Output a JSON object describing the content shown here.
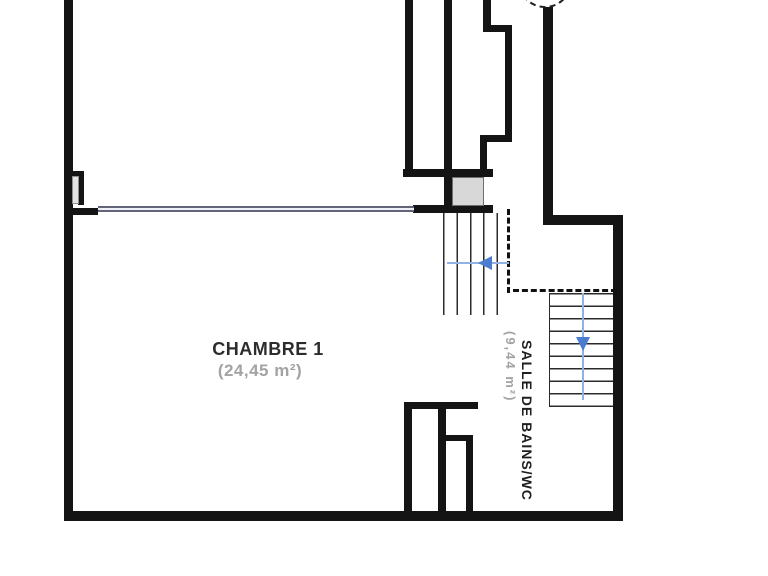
{
  "plan": {
    "type": "floor-plan",
    "rooms": {
      "chambre": {
        "label": "CHAMBRE 1",
        "area": "(24,45 m²)"
      },
      "bathroom": {
        "label": "SALLE DE BAINS/WC",
        "area": "(9,44 m²)"
      }
    },
    "stairs": {
      "upper": {
        "treads": 5,
        "direction": "left",
        "icon": "stair-arrow-left-icon"
      },
      "lower": {
        "treads": 9,
        "direction": "down",
        "icon": "stair-arrow-down-icon"
      }
    },
    "symbols": {
      "window": "double-line-window",
      "dashed_opening": "overhead-opening-dashed-line",
      "compass": "partial-dashed-circle"
    },
    "colors": {
      "wall": "#141414",
      "landing_fill": "#d8d8d8",
      "label_text": "#2c2c2c",
      "area_text": "#a3a3a3",
      "stair_arrow": "#4a7cd0",
      "stair_runline": "#8fb2e2",
      "window_frame": "#63637a",
      "background": "#ffffff"
    }
  }
}
